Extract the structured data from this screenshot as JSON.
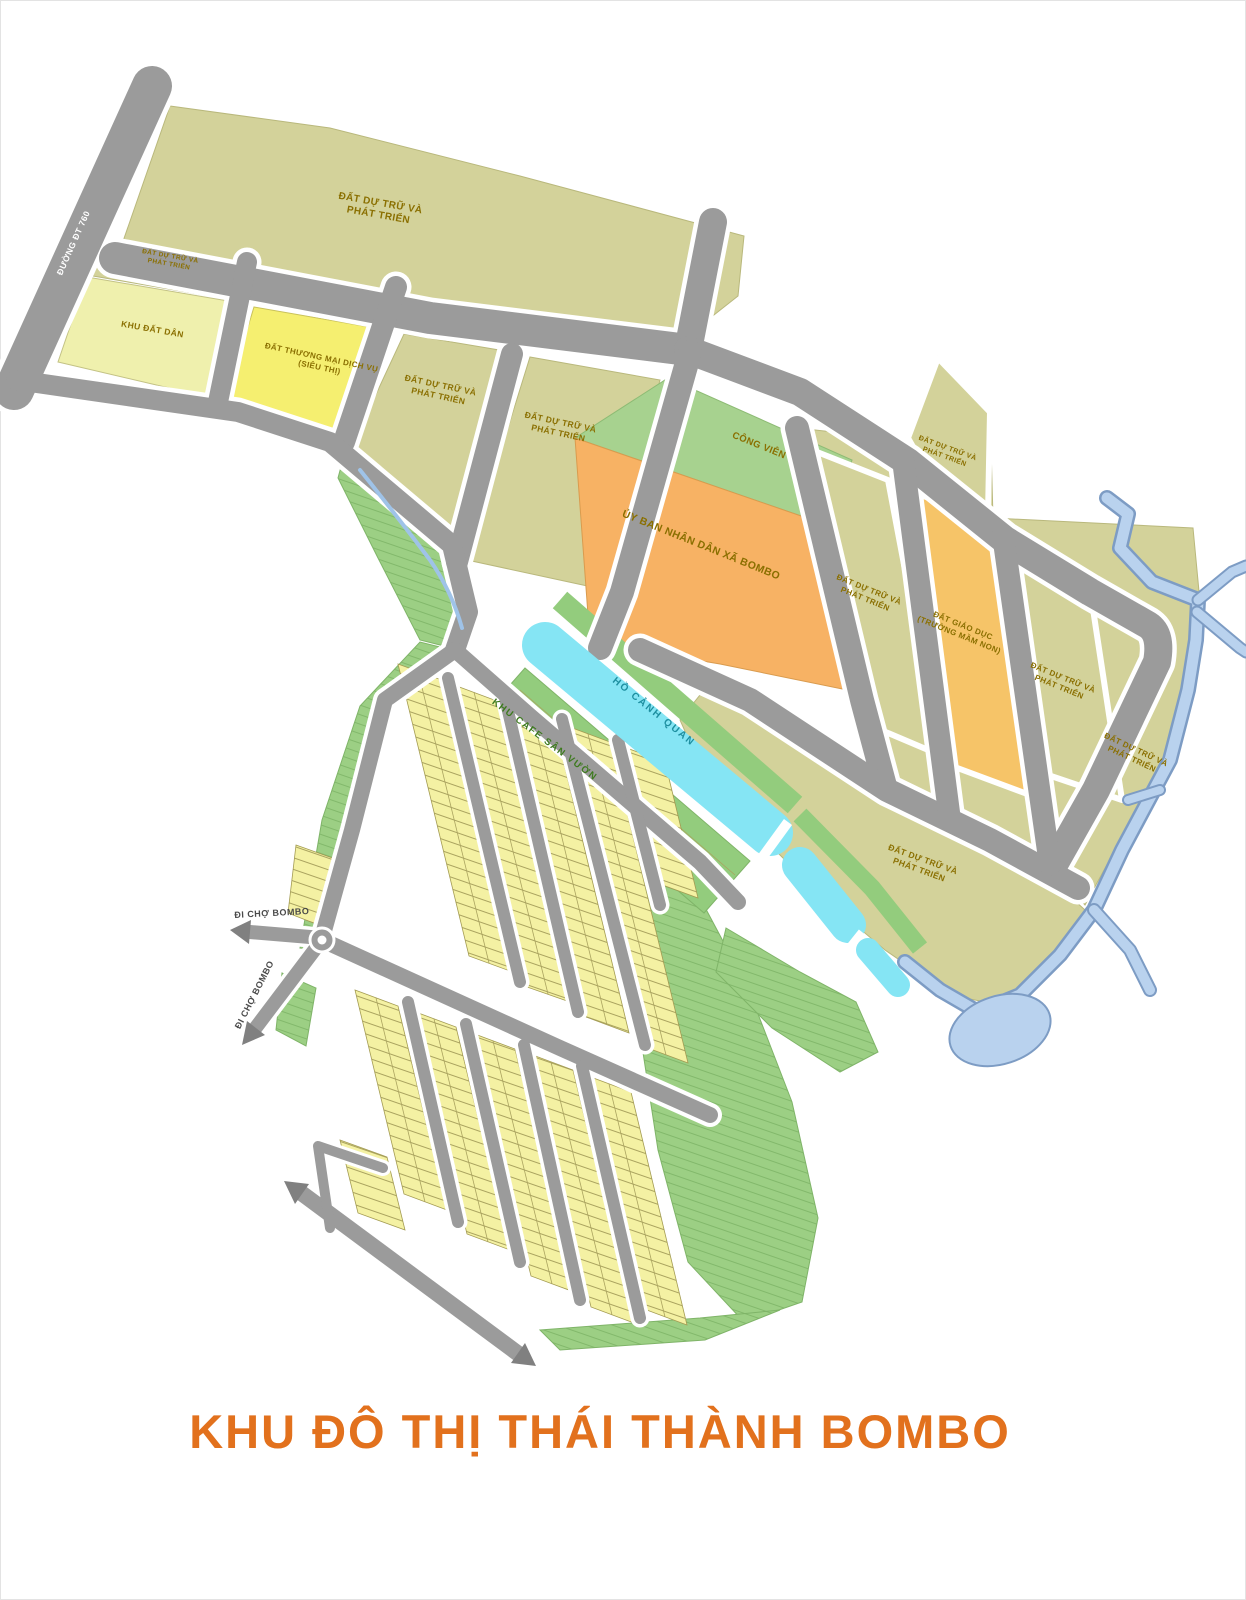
{
  "title": "KHU ĐÔ THỊ THÁI THÀNH BOMBO",
  "labels": {
    "road_dt760": "ĐƯỜNG ĐT 760",
    "to_market": "ĐI CHỢ BOMBO",
    "reserve1": "ĐẤT DỰ TRỮ VÀ",
    "reserve2": "PHÁT TRIỂN",
    "residential": "KHU ĐẤT DÂN",
    "commercial1": "ĐẤT THƯƠNG MẠI DỊCH VỤ",
    "commercial2": "(SIÊU THỊ)",
    "park": "CÔNG VIÊN",
    "committee": "ỦY BAN NHÂN DÂN XÃ BOMBO",
    "education1": "ĐẤT GIÁO DỤC",
    "education2": "(TRƯỜNG MẦM NON)",
    "lake": "HỒ CẢNH QUAN",
    "cafe": "KHU CAFE SÂN VƯỜN"
  },
  "colors": {
    "title_accent": "#e2711d",
    "road": "#9b9b9b",
    "reserve_parcel": "#d3d29a",
    "residential_parcel": "#eff0ad",
    "commercial_parcel": "#f5ef70",
    "committee_parcel": "#f7b264",
    "education_parcel": "#f6c468",
    "park_green": "#a7d28f",
    "greenery": "#9ccf84",
    "lots": "#f4f1a3",
    "lake": "#85e5f4",
    "river": "#b9d2ee"
  }
}
